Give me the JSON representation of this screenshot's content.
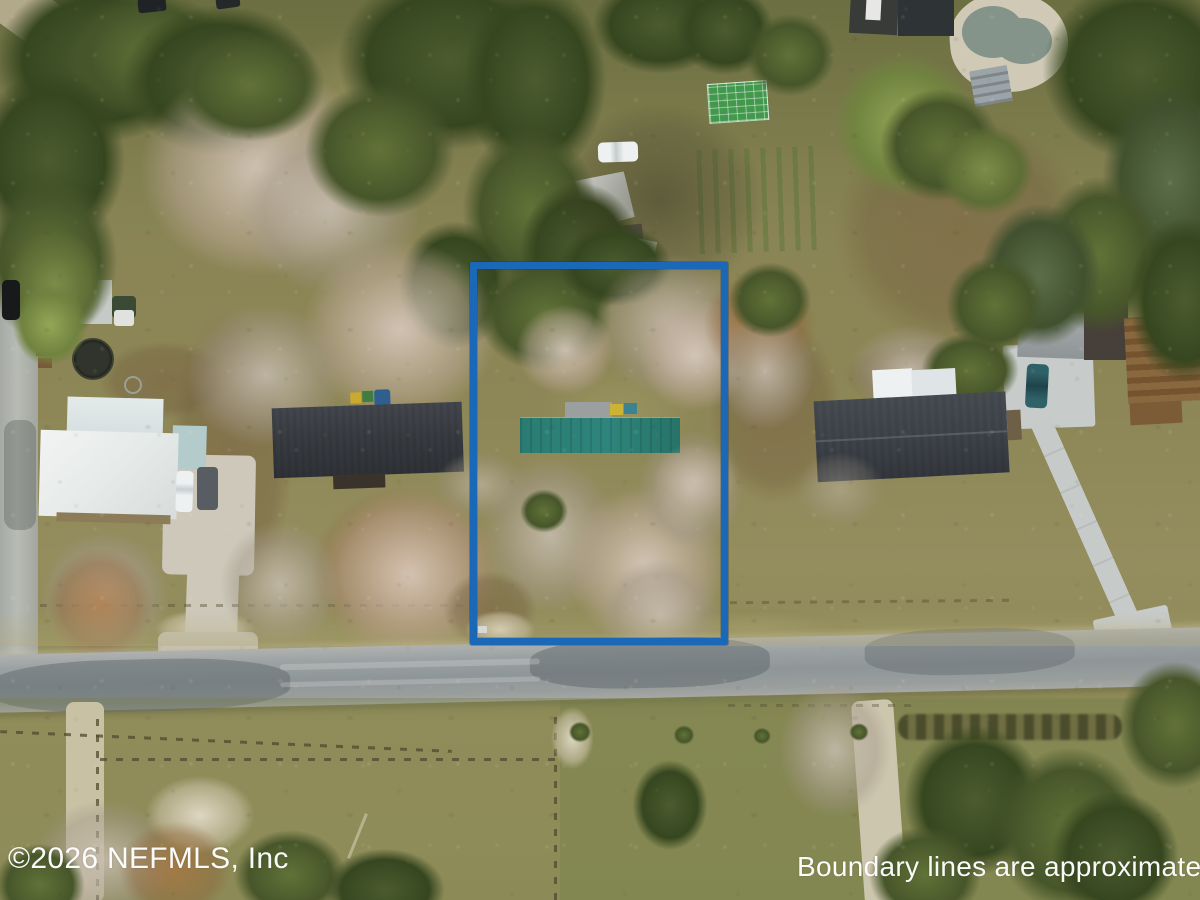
{
  "watermarks": {
    "copyright": "©2026 NEFMLS, Inc",
    "disclaimer": "Boundary lines are approximate",
    "color": "#ffffff"
  },
  "boundary_overlay": {
    "label": "approximate-property-boundary",
    "shape": "rectangle",
    "color": "#1b67b8"
  },
  "scene": {
    "type": "aerial-drone-photograph",
    "description": "Overhead winter view of rural residential lots along a gray paved road; the outlined center lot holds a long teal-green roofed home among bare trees, flanked by a white-metal-roof house and two dark-shingle-roof houses, with a kidney-shaped pool, greenhouse and sheds on neighboring parcels.",
    "key_colors": {
      "grass": "#8d8757",
      "dark_trees": "#36461f",
      "bare_trees": "#d8c9bc",
      "road": "#939a9b",
      "subject_roof_teal": "#2c8177",
      "neighbor_roof_dark": "#3a3e44",
      "neighbor_roof_white": "#e9eceb",
      "pool_water": "#84948a",
      "pool_deck": "#cfc9b6"
    }
  }
}
